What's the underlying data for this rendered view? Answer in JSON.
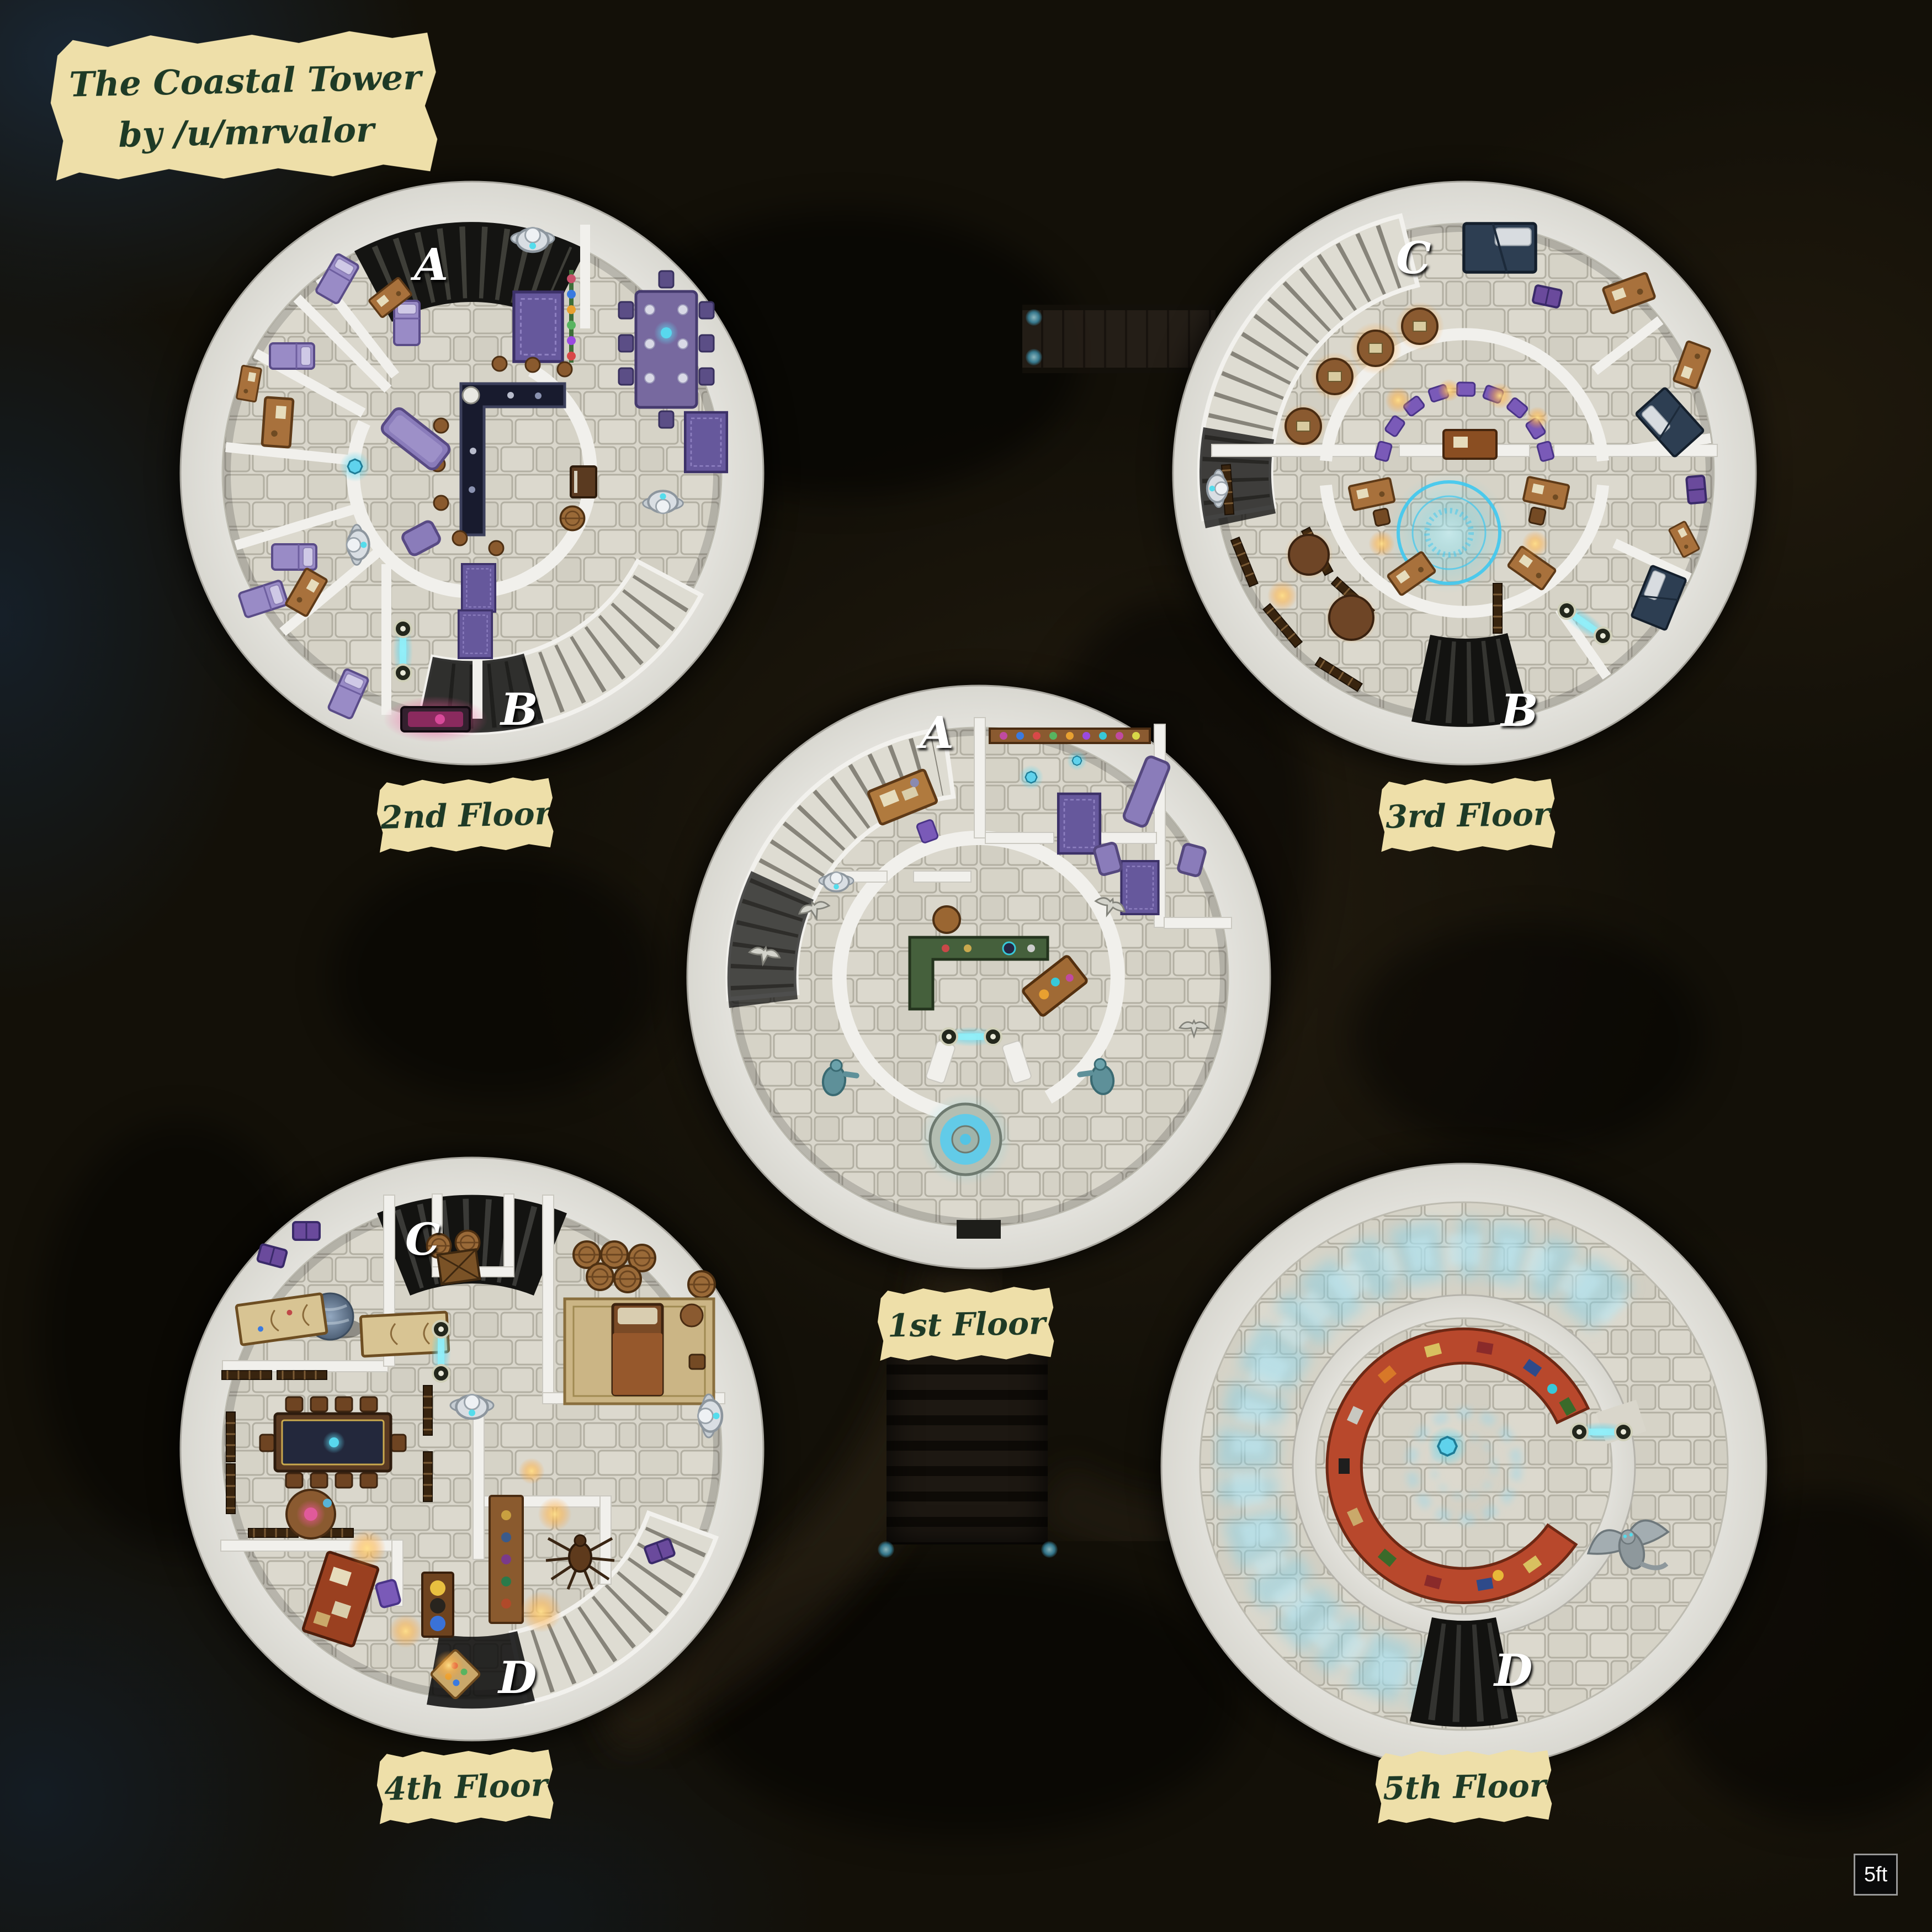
{
  "map": {
    "title_line1": "The Coastal Tower",
    "title_line2": "by /u/mrvalor",
    "scale_label": "5ft"
  },
  "floors": {
    "first": {
      "label": "1st Floor",
      "stair_a": "A"
    },
    "second": {
      "label": "2nd Floor",
      "stair_a": "A",
      "stair_b": "B"
    },
    "third": {
      "label": "3rd Floor",
      "stair_c": "C",
      "stair_b": "B"
    },
    "fourth": {
      "label": "4th Floor",
      "stair_c": "C",
      "stair_d": "D"
    },
    "fifth": {
      "label": "5th Floor",
      "stair_d": "D"
    }
  },
  "colors": {
    "parchment": "#eedfa9",
    "ink": "#1e3a26",
    "marble": "#e9e8e4",
    "stone_floor": "#d9d6cb",
    "teleporter_glow": "#7fe4f4",
    "rune_glow": "#8cd2e6",
    "candle_glow": "#ffb347"
  }
}
